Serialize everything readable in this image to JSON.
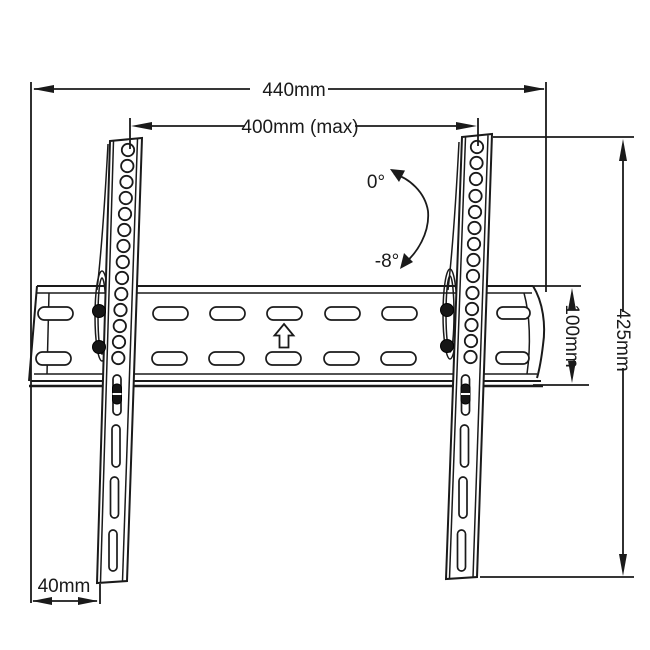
{
  "drawing": {
    "labels": {
      "overall_width": "440mm",
      "hole_pattern_width": "400mm (max)",
      "bracket_height": "425mm",
      "plate_height": "100mm",
      "wall_clearance": "40mm",
      "tilt_up": "0°",
      "tilt_down": "-8°"
    },
    "colors": {
      "line": "#1a1a1a",
      "background": "#ffffff"
    }
  }
}
